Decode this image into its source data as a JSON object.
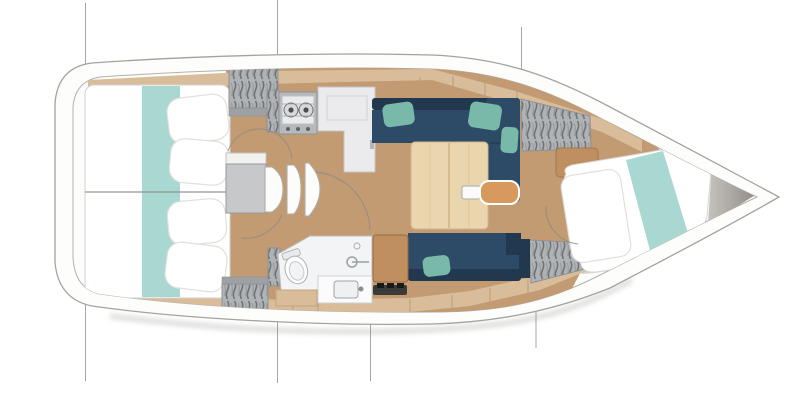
{
  "diagram": {
    "type": "boat-floorplan",
    "view": "top-down interior layout of a sailboat",
    "regions": {
      "aft_cabin": "aft double berth cabin",
      "saloon": "saloon with L-settee, table and bench",
      "galley": "galley with two-burner stove and L-shaped counter",
      "head": "bathroom with toilet and sink",
      "forward_cabin": "forward berth cabin at the bow"
    },
    "items": [
      "hull-outline",
      "deck-inner-line",
      "section-line",
      "aft-berth",
      "mattress-runner",
      "pillow",
      "hanging-locker",
      "companionway-steps",
      "stove",
      "galley-counter",
      "settee-port",
      "settee-starboard",
      "saloon-table",
      "table-remote",
      "ottoman",
      "seat-cushion-cabinet",
      "storage-strip",
      "head-room",
      "toilet",
      "sink",
      "shower-fitting",
      "forward-berth",
      "bow-shelf",
      "door-swing-arc",
      "deck-plank-seam"
    ]
  },
  "colors": {
    "hull_stroke": "#a5a29e",
    "inner_stroke": "#b3b0ac",
    "navy": "#2d4a66",
    "navy_dark": "#22384e",
    "teal_pillow": "#79b9aa",
    "runner_teal": "#a9d7d1",
    "floor_tan": "#c29b73",
    "deck_tan": "#d9bd9b",
    "wood": "#e9d6ae",
    "orange": "#d89a5c",
    "cabinet_brown": "#bf8f60",
    "locker_gray": "#b0b3b5",
    "bow_gray": "#9b9892",
    "section_line": "#a9a7a4",
    "bed_white": "#ffffff"
  }
}
